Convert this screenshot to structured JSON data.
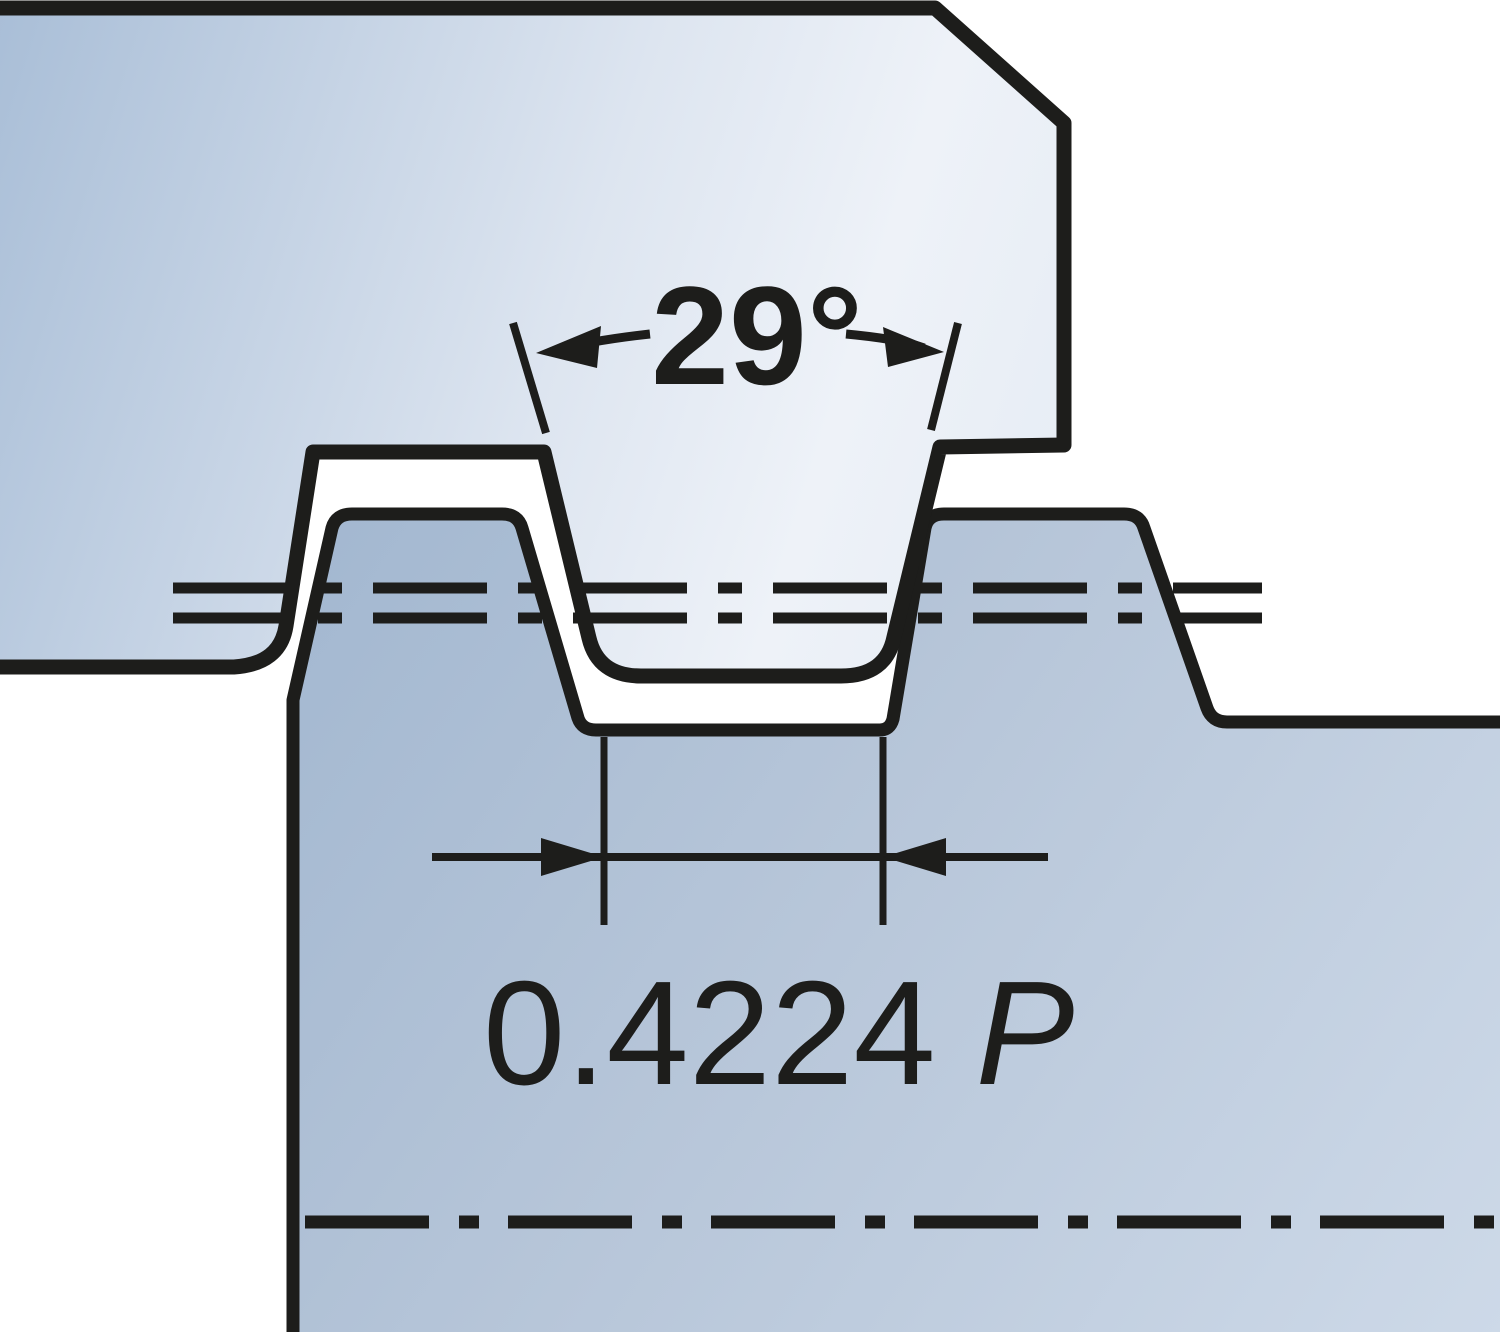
{
  "diagram": {
    "kind": "thread-profile-engineering-drawing",
    "angle_dimension": {
      "label": "29°"
    },
    "width_dimension": {
      "value": "0.4224",
      "symbol": "P"
    },
    "colors": {
      "outline": "#1d1d1b",
      "background": "#ffffff",
      "tool_gradient_start": "#a9bed7",
      "tool_gradient_end": "#eef2f8",
      "workpiece_gradient_start": "#a2b7d0",
      "workpiece_gradient_end": "#cdd9e8"
    }
  }
}
